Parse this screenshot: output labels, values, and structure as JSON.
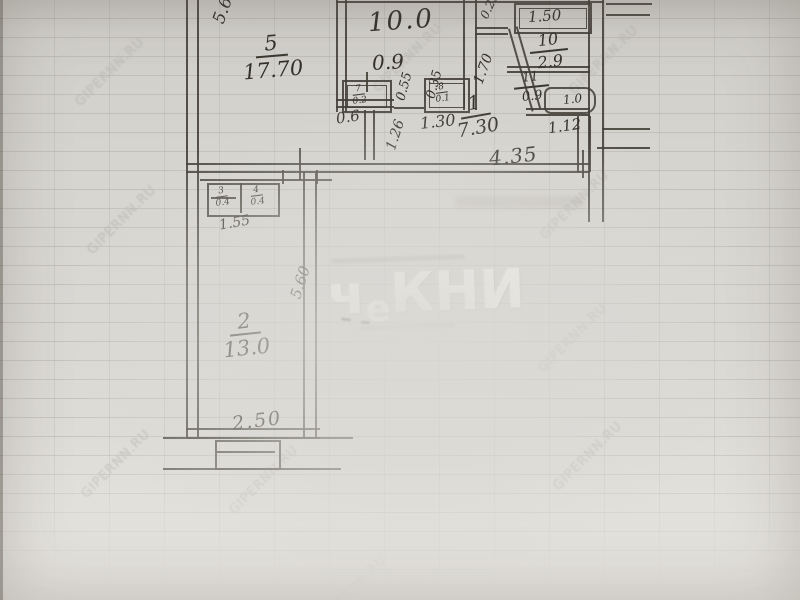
{
  "watermark": {
    "text": "GIPERNN.RU"
  },
  "logo": {
    "p1": "ч",
    "p2": "е",
    "p3": "КНИ"
  },
  "plan": {
    "room5": {
      "num": "5",
      "area": "17.70"
    },
    "room2": {
      "num": "2",
      "area": "13.0"
    },
    "hall": {
      "num": "1",
      "area": "7.30"
    },
    "kitchen": {
      "area": "10.0"
    },
    "bath": {
      "num": "10",
      "area": "2.9"
    },
    "wc": {
      "num": "11",
      "area": "0.9"
    },
    "shelf_label": "1.50",
    "fixture_label": "1.0",
    "closets": {
      "k1": {
        "num": "7",
        "area": "0.2"
      },
      "k2": {
        "num": "8",
        "area": "0.1"
      },
      "h1": {
        "num": "3",
        "area": "0.4"
      },
      "h2": {
        "num": "4",
        "area": "0.4"
      }
    },
    "dims": {
      "left_height": "5.6",
      "kitchen_window": "0.9",
      "door_a": "0.55",
      "door_b": "0.35",
      "door_c": "0.6",
      "hall_a": "1.26",
      "hall_b": "1.30",
      "hall_c": "1.70",
      "top_a": "0.25",
      "wc_width": "1.12",
      "hall_width": "4.35",
      "closet_width": "1.55",
      "room2_height": "5.60",
      "room2_width": "2.50"
    }
  }
}
